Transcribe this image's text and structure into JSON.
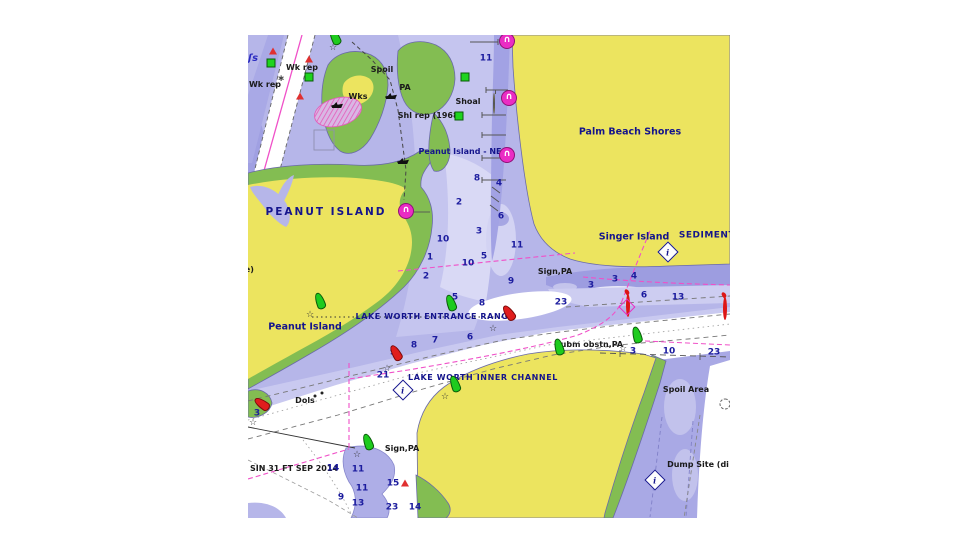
{
  "map": {
    "type": "nautical-chart",
    "labels": {
      "wk_rep_1": "Wk rep",
      "wk_rep_2": "Wk rep",
      "spoil": "Spoil",
      "wks": "Wks",
      "pa": "PA",
      "shoal": "Shoal",
      "shl_rep": "Shl rep (1968)",
      "peanut_island_ne": "Peanut Island - NE",
      "palm_beach_shores": "Palm Beach Shores",
      "peanut_island_caps": "PEANUT ISLAND",
      "note": "(note)",
      "singer_island": "Singer Island",
      "sediment": "SEDIMENT",
      "sign_pa_1": "Sign,PA",
      "peanut_island_lower": "Peanut Island",
      "entrance_range": "LAKE WORTH ENTRANCE RANGE",
      "inner_channel": "LAKE WORTH INNER CHANNEL",
      "subm_obstn": "Subm obstn,PA",
      "dols": "Dols",
      "spoil_area": "Spoil Area",
      "dump_site": "Dump Site (di",
      "sign_pa_2": "Sign,PA",
      "basin_note": "SIN 31 FT SEP 2014",
      "ls_symbol": "ʃs"
    },
    "depths": [
      {
        "v": "11",
        "x": 238,
        "y": 24
      },
      {
        "v": "4",
        "x": 251,
        "y": 149
      },
      {
        "v": "8",
        "x": 229,
        "y": 144
      },
      {
        "v": "2",
        "x": 211,
        "y": 168
      },
      {
        "v": "6",
        "x": 253,
        "y": 182
      },
      {
        "v": "3",
        "x": 231,
        "y": 197
      },
      {
        "v": "10",
        "x": 195,
        "y": 205
      },
      {
        "v": "11",
        "x": 269,
        "y": 211
      },
      {
        "v": "1",
        "x": 182,
        "y": 223
      },
      {
        "v": "10",
        "x": 220,
        "y": 229
      },
      {
        "v": "5",
        "x": 236,
        "y": 222
      },
      {
        "v": "2",
        "x": 178,
        "y": 242
      },
      {
        "v": "9",
        "x": 263,
        "y": 247
      },
      {
        "v": "5",
        "x": 207,
        "y": 263
      },
      {
        "v": "8",
        "x": 234,
        "y": 269
      },
      {
        "v": "23",
        "x": 313,
        "y": 268
      },
      {
        "v": "3",
        "x": 343,
        "y": 251
      },
      {
        "v": "3",
        "x": 367,
        "y": 245
      },
      {
        "v": "4",
        "x": 386,
        "y": 242
      },
      {
        "v": "6",
        "x": 396,
        "y": 261
      },
      {
        "v": "13",
        "x": 430,
        "y": 263
      },
      {
        "v": "8",
        "x": 166,
        "y": 311
      },
      {
        "v": "7",
        "x": 187,
        "y": 306
      },
      {
        "v": "6",
        "x": 222,
        "y": 303
      },
      {
        "v": "9",
        "x": 145,
        "y": 318
      },
      {
        "v": "21",
        "x": 135,
        "y": 341
      },
      {
        "v": "3",
        "x": 9,
        "y": 379
      },
      {
        "v": "3",
        "x": 385,
        "y": 317
      },
      {
        "v": "10",
        "x": 421,
        "y": 317
      },
      {
        "v": "23",
        "x": 466,
        "y": 318
      },
      {
        "v": "14",
        "x": 85,
        "y": 434
      },
      {
        "v": "11",
        "x": 110,
        "y": 435
      },
      {
        "v": "11",
        "x": 114,
        "y": 454
      },
      {
        "v": "9",
        "x": 93,
        "y": 463
      },
      {
        "v": "13",
        "x": 110,
        "y": 469
      },
      {
        "v": "15",
        "x": 145,
        "y": 449
      },
      {
        "v": "23",
        "x": 144,
        "y": 473
      },
      {
        "v": "14",
        "x": 167,
        "y": 473
      }
    ],
    "symbols": {
      "green_buoys": [
        {
          "x": 87,
          "y": 2,
          "rot": -25
        },
        {
          "x": 72,
          "y": 266,
          "rot": -20
        },
        {
          "x": 203,
          "y": 268,
          "rot": -20
        },
        {
          "x": 207,
          "y": 349,
          "rot": -20
        },
        {
          "x": 120,
          "y": 407,
          "rot": -20
        },
        {
          "x": 389,
          "y": 300,
          "rot": -15
        },
        {
          "x": 311,
          "y": 312,
          "rot": -15
        }
      ],
      "red_buoys": [
        {
          "x": 148,
          "y": 318,
          "rot": -30
        },
        {
          "x": 14,
          "y": 369,
          "rot": -55
        },
        {
          "x": 261,
          "y": 278,
          "rot": -35
        }
      ],
      "stars": [
        {
          "v": "☆",
          "x": 85,
          "y": 13
        },
        {
          "v": "☆",
          "x": 62,
          "y": 280
        },
        {
          "v": "☆",
          "x": 245,
          "y": 294
        },
        {
          "v": "☆",
          "x": 139,
          "y": 334
        },
        {
          "v": "☆",
          "x": 5,
          "y": 388
        },
        {
          "v": "☆",
          "x": 197,
          "y": 362
        },
        {
          "v": "☆",
          "x": 109,
          "y": 420
        },
        {
          "v": "☆",
          "x": 375,
          "y": 314
        }
      ],
      "red_triangles": [
        {
          "x": 25,
          "y": 16
        },
        {
          "x": 61,
          "y": 24
        },
        {
          "x": 52,
          "y": 61
        },
        {
          "x": 157,
          "y": 448
        }
      ],
      "green_squares": [
        {
          "x": 23,
          "y": 28
        },
        {
          "x": 61,
          "y": 42
        },
        {
          "x": 217,
          "y": 42
        },
        {
          "x": 211,
          "y": 81
        }
      ],
      "anchorage_buoys": [
        {
          "v": "∩",
          "x": 259,
          "y": 6
        },
        {
          "v": "∩",
          "x": 261,
          "y": 63
        },
        {
          "v": "∩",
          "x": 259,
          "y": 120
        },
        {
          "v": "∩",
          "x": 158,
          "y": 176
        }
      ],
      "lighted_red_buoys": [
        {
          "x": 378,
          "y": 261
        },
        {
          "x": 471,
          "y": 264
        }
      ],
      "magenta_diamonds": [
        {
          "x": 379,
          "y": 272
        }
      ],
      "info_markers": [
        {
          "v": "i",
          "x": 420,
          "y": 217
        },
        {
          "v": "i",
          "x": 155,
          "y": 355
        },
        {
          "v": "i",
          "x": 407,
          "y": 445
        }
      ],
      "wrecks": [
        {
          "x": 89,
          "y": 70
        },
        {
          "x": 143,
          "y": 61
        },
        {
          "x": 155,
          "y": 126
        }
      ],
      "yellow_buoys": [
        {
          "x": 245,
          "y": 59
        }
      ],
      "dashed_circles": [
        {
          "x": 477,
          "y": 369
        }
      ],
      "hazard_asterisks": [
        {
          "v": "∗",
          "x": 33,
          "y": 44
        }
      ],
      "dolphin_posts": [
        {
          "x": 67,
          "y": 361
        },
        {
          "x": 74,
          "y": 358
        }
      ]
    },
    "colors": {
      "land": "#ece45f",
      "vegetation": "#83bd52",
      "water_base": "#b6b6e9",
      "water_shallow": "#9d9de0",
      "water_deep": "#ffffff",
      "magenta": "#ea2cc4",
      "buoy_green": "#1ecb1e",
      "buoy_red": "#e01d1d",
      "label_navy": "#14148c",
      "label_black": "#1a1a1a"
    }
  }
}
